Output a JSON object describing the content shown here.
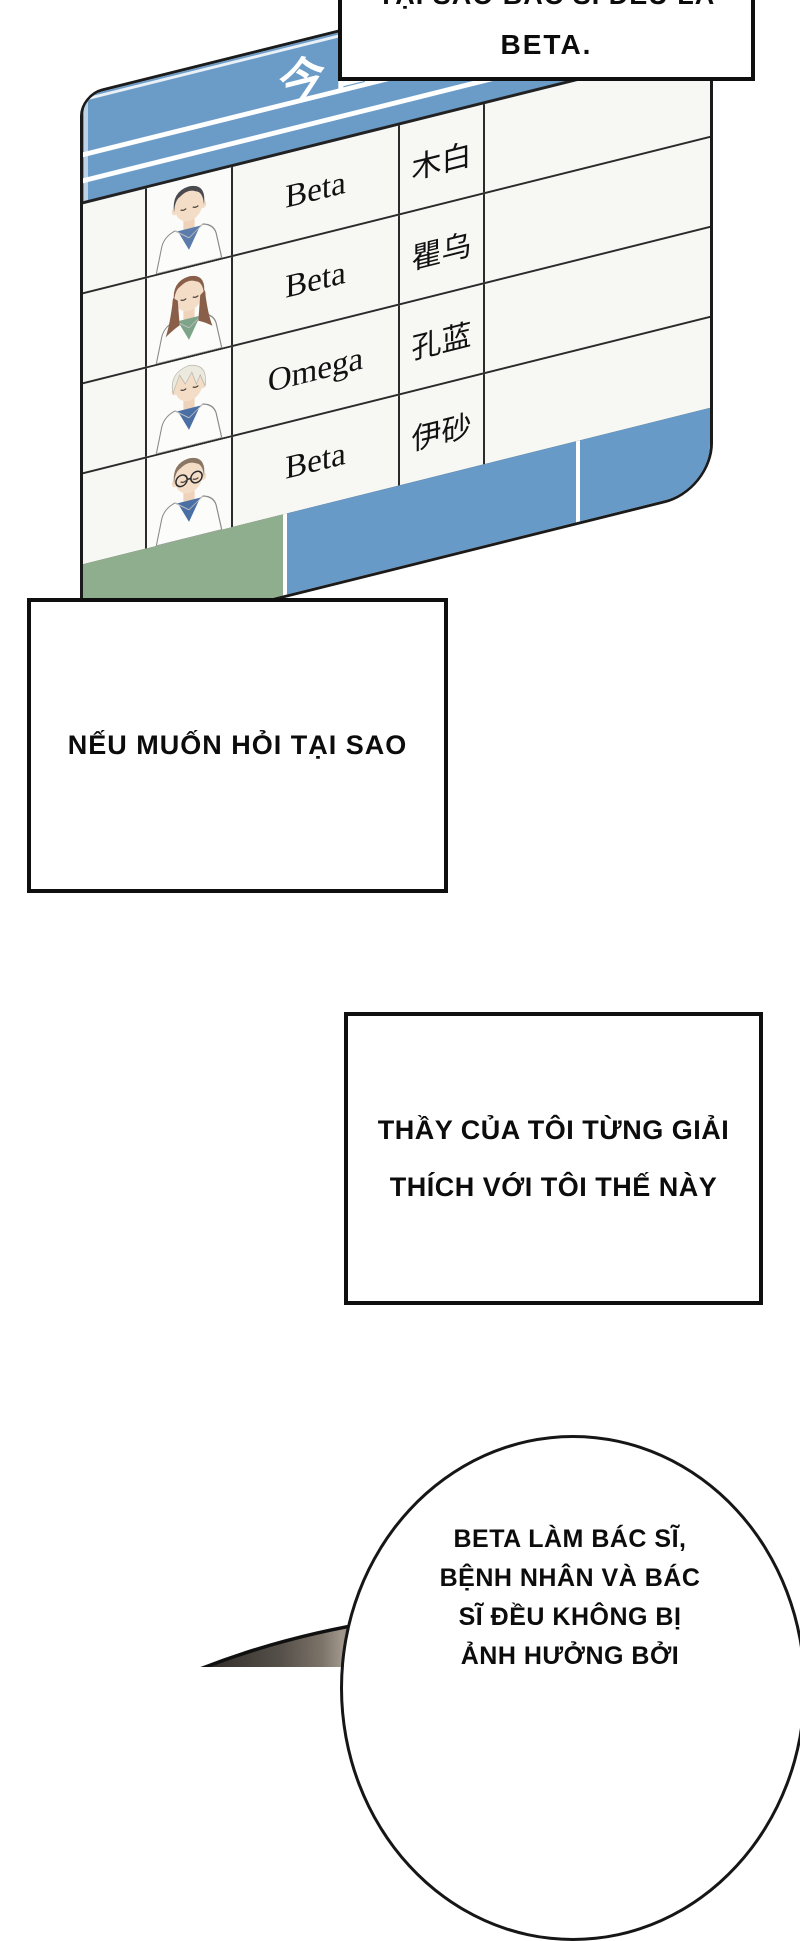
{
  "top_box": {
    "partial_line": "TẠI SAO BÁC SĨ ĐỀU LÀ",
    "main_line": "BETA."
  },
  "board": {
    "header_title": "今日",
    "colors": {
      "header_blue": "#6b9cc8",
      "footer_green": "#8fae8e",
      "footer_blue": "#679ac7",
      "cell_bg": "#f7f7f4",
      "grid": "#2b2b2b"
    },
    "rows": [
      {
        "type": "Beta",
        "name": "木白",
        "avatar": {
          "style": "short",
          "hair": "#4b4a4f",
          "shirt": "#5b7cab",
          "glasses": false
        }
      },
      {
        "type": "Beta",
        "name": "瞿乌",
        "avatar": {
          "style": "long",
          "hair": "#8a5f4a",
          "shirt": "#7da489",
          "glasses": false
        }
      },
      {
        "type": "Omega",
        "name": "孔蓝",
        "avatar": {
          "style": "messy",
          "hair": "#eceade",
          "shirt": "#4a6fa5",
          "glasses": false
        }
      },
      {
        "type": "Beta",
        "name": "伊砂",
        "avatar": {
          "style": "short",
          "hair": "#8a7663",
          "shirt": "#4a6fa5",
          "glasses": true
        }
      }
    ]
  },
  "caption1": {
    "text": "NẾU MUỐN HỎI TẠI SAO"
  },
  "caption2": {
    "lines": [
      "THẦY CỦA TÔI TỪNG GIẢI",
      "THÍCH VỚI TÔI THẾ NÀY"
    ]
  },
  "bubble": {
    "lines": [
      "BETA LÀM BÁC SĨ,",
      "BỆNH NHÂN VÀ BÁC",
      "SĨ ĐỀU KHÔNG BỊ",
      "ẢNH HƯỞNG BỞI"
    ]
  },
  "silhouette_colors": [
    "#2b2723",
    "#56504a",
    "#7d7469",
    "#a0978c",
    "#8a8176",
    "#5f584f",
    "#48423b"
  ]
}
